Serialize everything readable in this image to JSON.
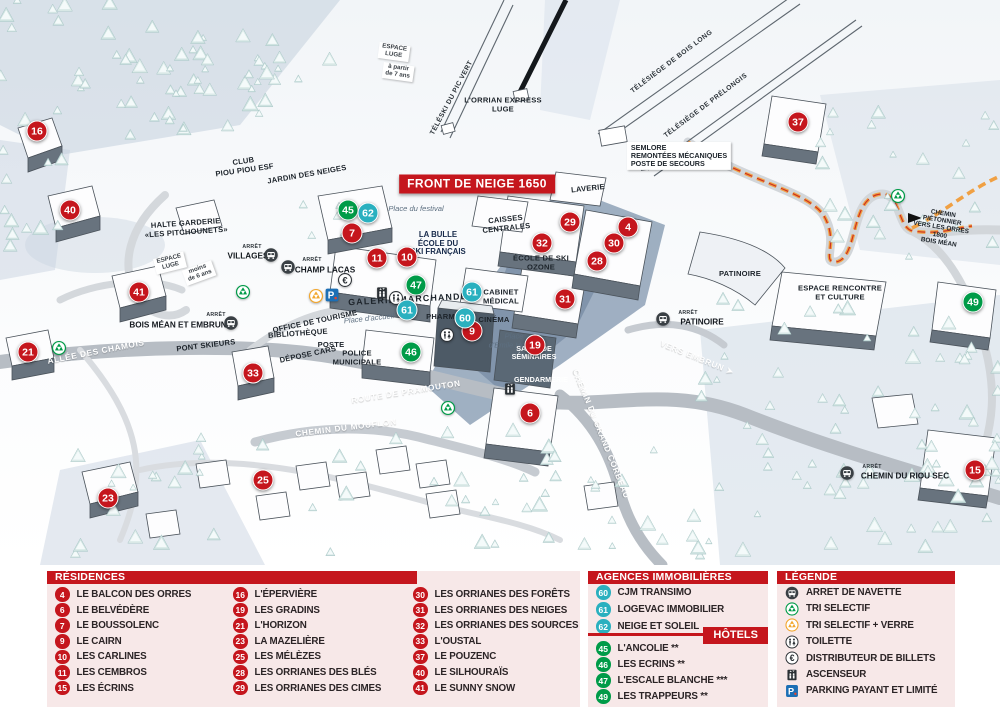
{
  "map": {
    "banner": "FRONT DE NEIGE 1650",
    "markers": [
      {
        "n": "16",
        "color": "red",
        "x": 37,
        "y": 131
      },
      {
        "n": "40",
        "color": "red",
        "x": 70,
        "y": 210
      },
      {
        "n": "41",
        "color": "red",
        "x": 139,
        "y": 292
      },
      {
        "n": "21",
        "color": "red",
        "x": 28,
        "y": 352
      },
      {
        "n": "33",
        "color": "red",
        "x": 253,
        "y": 373
      },
      {
        "n": "23",
        "color": "red",
        "x": 108,
        "y": 498
      },
      {
        "n": "25",
        "color": "red",
        "x": 263,
        "y": 480
      },
      {
        "n": "7",
        "color": "red",
        "x": 352,
        "y": 233
      },
      {
        "n": "11",
        "color": "red",
        "x": 377,
        "y": 258
      },
      {
        "n": "10",
        "color": "red",
        "x": 407,
        "y": 257
      },
      {
        "n": "29",
        "color": "red",
        "x": 570,
        "y": 222
      },
      {
        "n": "32",
        "color": "red",
        "x": 542,
        "y": 243
      },
      {
        "n": "4",
        "color": "red",
        "x": 628,
        "y": 227
      },
      {
        "n": "30",
        "color": "red",
        "x": 614,
        "y": 243
      },
      {
        "n": "28",
        "color": "red",
        "x": 597,
        "y": 261
      },
      {
        "n": "31",
        "color": "red",
        "x": 565,
        "y": 299
      },
      {
        "n": "19",
        "color": "red",
        "x": 535,
        "y": 345
      },
      {
        "n": "9",
        "color": "red",
        "x": 472,
        "y": 331
      },
      {
        "n": "6",
        "color": "red",
        "x": 530,
        "y": 413
      },
      {
        "n": "37",
        "color": "red",
        "x": 798,
        "y": 122
      },
      {
        "n": "15",
        "color": "red",
        "x": 975,
        "y": 470
      },
      {
        "n": "45",
        "color": "green",
        "x": 348,
        "y": 210
      },
      {
        "n": "47",
        "color": "green",
        "x": 416,
        "y": 285
      },
      {
        "n": "46",
        "color": "green",
        "x": 411,
        "y": 352
      },
      {
        "n": "49",
        "color": "green",
        "x": 973,
        "y": 302
      },
      {
        "n": "62",
        "color": "teal",
        "x": 368,
        "y": 213
      },
      {
        "n": "61",
        "color": "teal",
        "x": 472,
        "y": 292
      },
      {
        "n": "61",
        "color": "teal",
        "x": 407,
        "y": 310
      },
      {
        "n": "60",
        "color": "teal",
        "x": 465,
        "y": 318
      }
    ],
    "labels": [
      {
        "text": "ESPACE\nLUGE",
        "x": 394,
        "y": 52,
        "rot": 8,
        "cls": "sign"
      },
      {
        "text": "à partir\nde 7 ans",
        "x": 398,
        "y": 72,
        "rot": 8,
        "cls": "sign"
      },
      {
        "text": "ESPACE\nLUGE",
        "x": 170,
        "y": 263,
        "rot": -14,
        "cls": "sign"
      },
      {
        "text": "moins\nde 6 ans",
        "x": 199,
        "y": 273,
        "rot": -20,
        "cls": "sign"
      },
      {
        "text": "TÉLÉSKI DU PIC VERT",
        "x": 452,
        "y": 98,
        "rot": -62,
        "cls": "lift"
      },
      {
        "text": "TÉLÉSIÈGE DE BOIS LONG",
        "x": 672,
        "y": 62,
        "rot": -37,
        "cls": "lift"
      },
      {
        "text": "TÉLÉSIÈGE DE PRÉLONGIS",
        "x": 706,
        "y": 106,
        "rot": -37,
        "cls": "lift"
      },
      {
        "text": "L'ORRIAN EXPRESS\nLUGE",
        "x": 503,
        "y": 105,
        "cls": "place"
      },
      {
        "text": "SEMLORE\nREMONTÉES MÉCANIQUES\nPOSTE DE SECOURS",
        "x": 679,
        "y": 156,
        "cls": "boxed"
      },
      {
        "text": "CLUB\nPIOU PIOU ESF",
        "x": 244,
        "y": 166,
        "rot": -8,
        "cls": "place"
      },
      {
        "text": "JARDIN DES NEIGES",
        "x": 307,
        "y": 175,
        "rot": -10,
        "cls": "place"
      },
      {
        "text": "HALTE GARDERIE\n«LES PITCHOUNETS»",
        "x": 186,
        "y": 228,
        "rot": -4,
        "cls": "place"
      },
      {
        "text": "CAISSES\nCENTRALES",
        "x": 506,
        "y": 224,
        "rot": -6,
        "cls": "place"
      },
      {
        "text": "LAVERIE",
        "x": 588,
        "y": 189,
        "rot": -6,
        "cls": "place"
      },
      {
        "text": "LA BULLE\nÉCOLE DU\nSKI FRANÇAIS",
        "x": 438,
        "y": 244,
        "cls": "navy"
      },
      {
        "text": "GALERIE MARCHANDE",
        "x": 408,
        "y": 300,
        "rot": -3,
        "cls": "sp"
      },
      {
        "text": "ÉCOLE DE SKI\nOZONE",
        "x": 541,
        "y": 263,
        "cls": "place"
      },
      {
        "text": "CABINET\nMÉDICAL",
        "x": 501,
        "y": 297,
        "cls": "place"
      },
      {
        "text": "CINÉMA",
        "x": 494,
        "y": 320,
        "cls": "place"
      },
      {
        "text": "PHARMACIE",
        "x": 450,
        "y": 317,
        "cls": "place"
      },
      {
        "text": "OFFICE DE TOURISME",
        "x": 315,
        "y": 322,
        "rot": -12,
        "cls": "place"
      },
      {
        "text": "BIBLIOTHÈQUE",
        "x": 298,
        "y": 334,
        "rot": -4,
        "cls": "place"
      },
      {
        "text": "POSTE",
        "x": 331,
        "y": 345,
        "cls": "place"
      },
      {
        "text": "DÉPOSE CARS",
        "x": 308,
        "y": 355,
        "rot": -12,
        "cls": "place"
      },
      {
        "text": "POLICE\nMUNICIPALE",
        "x": 357,
        "y": 358,
        "cls": "place"
      },
      {
        "text": "PONT SKIEURS",
        "x": 206,
        "y": 346,
        "rot": -7,
        "cls": "place"
      },
      {
        "text": "PATINOIRE",
        "x": 740,
        "y": 274,
        "cls": "place"
      },
      {
        "text": "ESPACE RENCONTRE\nET CULTURE",
        "x": 840,
        "y": 293,
        "cls": "place"
      },
      {
        "text": "CHEMIN PIÉTONNIER\nVERS LES ORRES 1800\nBOIS MÉAN",
        "x": 941,
        "y": 228,
        "rot": 9,
        "cls": "path-label"
      },
      {
        "text": "Place du festival",
        "x": 416,
        "y": 209,
        "cls": "it"
      },
      {
        "text": "Place\nd'Emile Hodoul",
        "x": 514,
        "y": 341,
        "cls": "it"
      },
      {
        "text": "Place d'accueil",
        "x": 369,
        "y": 319,
        "rot": -6,
        "cls": "it"
      },
      {
        "text": "ALLÉE DES CHAMOIS",
        "x": 96,
        "y": 352,
        "rot": -11,
        "cls": "road"
      },
      {
        "text": "ROUTE DE PRAMOUTON",
        "x": 406,
        "y": 392,
        "rot": -9,
        "cls": "road"
      },
      {
        "text": "CHEMIN DU MOUFLON",
        "x": 346,
        "y": 428,
        "rot": -7,
        "cls": "road"
      },
      {
        "text": "CHEMIN DU GRAND CORBEAU",
        "x": 601,
        "y": 434,
        "rot": 68,
        "cls": "road"
      },
      {
        "text": "VERS EMBRUN ➤",
        "x": 697,
        "y": 358,
        "rot": 22,
        "cls": "road"
      },
      {
        "text": "SALLE DE\nSÉMINAIRES",
        "x": 534,
        "y": 353,
        "cls": "wb"
      },
      {
        "text": "GENDARMERIE",
        "x": 541,
        "y": 380,
        "cls": "wb"
      },
      {
        "text": "ARRÊT",
        "x": 252,
        "y": 248,
        "cls": "stoptiny"
      },
      {
        "text": "VILLAGES",
        "x": 248,
        "y": 256,
        "cls": "stopname"
      },
      {
        "text": "ARRÊT",
        "x": 312,
        "y": 261,
        "cls": "stoptiny"
      },
      {
        "text": "CHAMP LACAS",
        "x": 325,
        "y": 270,
        "cls": "stopname"
      },
      {
        "text": "ARRÊT",
        "x": 216,
        "y": 316,
        "cls": "stoptiny"
      },
      {
        "text": "BOIS MÉAN ET EMBRUN",
        "x": 178,
        "y": 325,
        "cls": "stopname"
      },
      {
        "text": "ARRÊT",
        "x": 688,
        "y": 314,
        "cls": "stoptiny"
      },
      {
        "text": "PATINOIRE",
        "x": 702,
        "y": 322,
        "cls": "stopname"
      },
      {
        "text": "ARRÊT",
        "x": 872,
        "y": 468,
        "cls": "stoptiny"
      },
      {
        "text": "CHEMIN DU RIOU SEC",
        "x": 905,
        "y": 476,
        "cls": "stopname"
      }
    ],
    "icons": [
      {
        "type": "bus",
        "x": 271,
        "y": 255
      },
      {
        "type": "bus",
        "x": 288,
        "y": 267
      },
      {
        "type": "bus",
        "x": 231,
        "y": 323
      },
      {
        "type": "bus",
        "x": 663,
        "y": 319
      },
      {
        "type": "bus",
        "x": 847,
        "y": 473
      },
      {
        "type": "recycle-green",
        "x": 243,
        "y": 292
      },
      {
        "type": "recycle-green",
        "x": 59,
        "y": 348
      },
      {
        "type": "recycle-green",
        "x": 448,
        "y": 408
      },
      {
        "type": "recycle-green",
        "x": 898,
        "y": 196
      },
      {
        "type": "recycle-yellow",
        "x": 316,
        "y": 296
      },
      {
        "type": "parking",
        "x": 332,
        "y": 295
      },
      {
        "type": "euro",
        "x": 345,
        "y": 280
      },
      {
        "type": "elevator",
        "x": 382,
        "y": 293
      },
      {
        "type": "elevator",
        "x": 510,
        "y": 389
      },
      {
        "type": "toilet",
        "x": 396,
        "y": 298
      },
      {
        "type": "toilet",
        "x": 447,
        "y": 335
      }
    ]
  },
  "legend": {
    "residences": {
      "title": "RÉSIDENCES",
      "columns": [
        [
          {
            "num": "4",
            "color": "red",
            "label": "LE BALCON DES ORRES"
          },
          {
            "num": "6",
            "color": "red",
            "label": "LE BELVÉDÈRE"
          },
          {
            "num": "7",
            "color": "red",
            "label": "LE BOUSSOLENC"
          },
          {
            "num": "9",
            "color": "red",
            "label": "LE CAIRN"
          },
          {
            "num": "10",
            "color": "red",
            "label": "LES CARLINES"
          },
          {
            "num": "11",
            "color": "red",
            "label": "LES CEMBROS"
          },
          {
            "num": "15",
            "color": "red",
            "label": "LES ÉCRINS"
          }
        ],
        [
          {
            "num": "16",
            "color": "red",
            "label": "L'ÉPERVIÈRE"
          },
          {
            "num": "19",
            "color": "red",
            "label": "LES GRADINS"
          },
          {
            "num": "21",
            "color": "red",
            "label": "L'HORIZON"
          },
          {
            "num": "23",
            "color": "red",
            "label": "LA MAZELIÈRE"
          },
          {
            "num": "25",
            "color": "red",
            "label": "LES MÉLÈZES"
          },
          {
            "num": "28",
            "color": "red",
            "label": "LES ORRIANES DES BLÉS"
          },
          {
            "num": "29",
            "color": "red",
            "label": "LES ORRIANES DES CIMES"
          }
        ],
        [
          {
            "num": "30",
            "color": "red",
            "label": "LES ORRIANES DES FORÊTS"
          },
          {
            "num": "31",
            "color": "red",
            "label": "LES ORRIANES DES NEIGES"
          },
          {
            "num": "32",
            "color": "red",
            "label": "LES ORRIANES DES SOURCES"
          },
          {
            "num": "33",
            "color": "red",
            "label": "L'OUSTAL"
          },
          {
            "num": "37",
            "color": "red",
            "label": "LE POUZENC"
          },
          {
            "num": "40",
            "color": "red",
            "label": "LE SILHOURAÏS"
          },
          {
            "num": "41",
            "color": "red",
            "label": "LE SUNNY SNOW"
          }
        ]
      ]
    },
    "agences": {
      "title": "AGENCES IMMOBILIÈRES",
      "items": [
        {
          "num": "60",
          "color": "teal",
          "label": "CJM TRANSIMO"
        },
        {
          "num": "61",
          "color": "teal",
          "label": "LOGEVAC IMMOBILIER"
        },
        {
          "num": "62",
          "color": "teal",
          "label": "NEIGE ET SOLEIL"
        }
      ]
    },
    "hotels": {
      "title": "HÔTELS",
      "items": [
        {
          "num": "45",
          "color": "green",
          "label": "L'ANCOLIE **"
        },
        {
          "num": "46",
          "color": "green",
          "label": "LES ECRINS **"
        },
        {
          "num": "47",
          "color": "green",
          "label": "L'ESCALE BLANCHE ***"
        },
        {
          "num": "49",
          "color": "green",
          "label": "LES TRAPPEURS **"
        }
      ]
    },
    "legende": {
      "title": "LÉGENDE",
      "items": [
        {
          "icon": "bus",
          "label": "ARRET DE NAVETTE"
        },
        {
          "icon": "recycle-green",
          "label": "TRI SELECTIF"
        },
        {
          "icon": "recycle-yellow",
          "label": "TRI SELECTIF + VERRE"
        },
        {
          "icon": "toilet",
          "label": "TOILETTE"
        },
        {
          "icon": "euro",
          "label": "DISTRIBUTEUR DE BILLETS"
        },
        {
          "icon": "elevator",
          "label": "ASCENSEUR"
        },
        {
          "icon": "parking",
          "label": "PARKING PAYANT ET LIMITÉ"
        }
      ]
    },
    "colors": {
      "accent_red": "#c5161d",
      "green": "#009b48",
      "teal": "#2ab0bf",
      "panel_pink": "#f7e8e8"
    }
  }
}
